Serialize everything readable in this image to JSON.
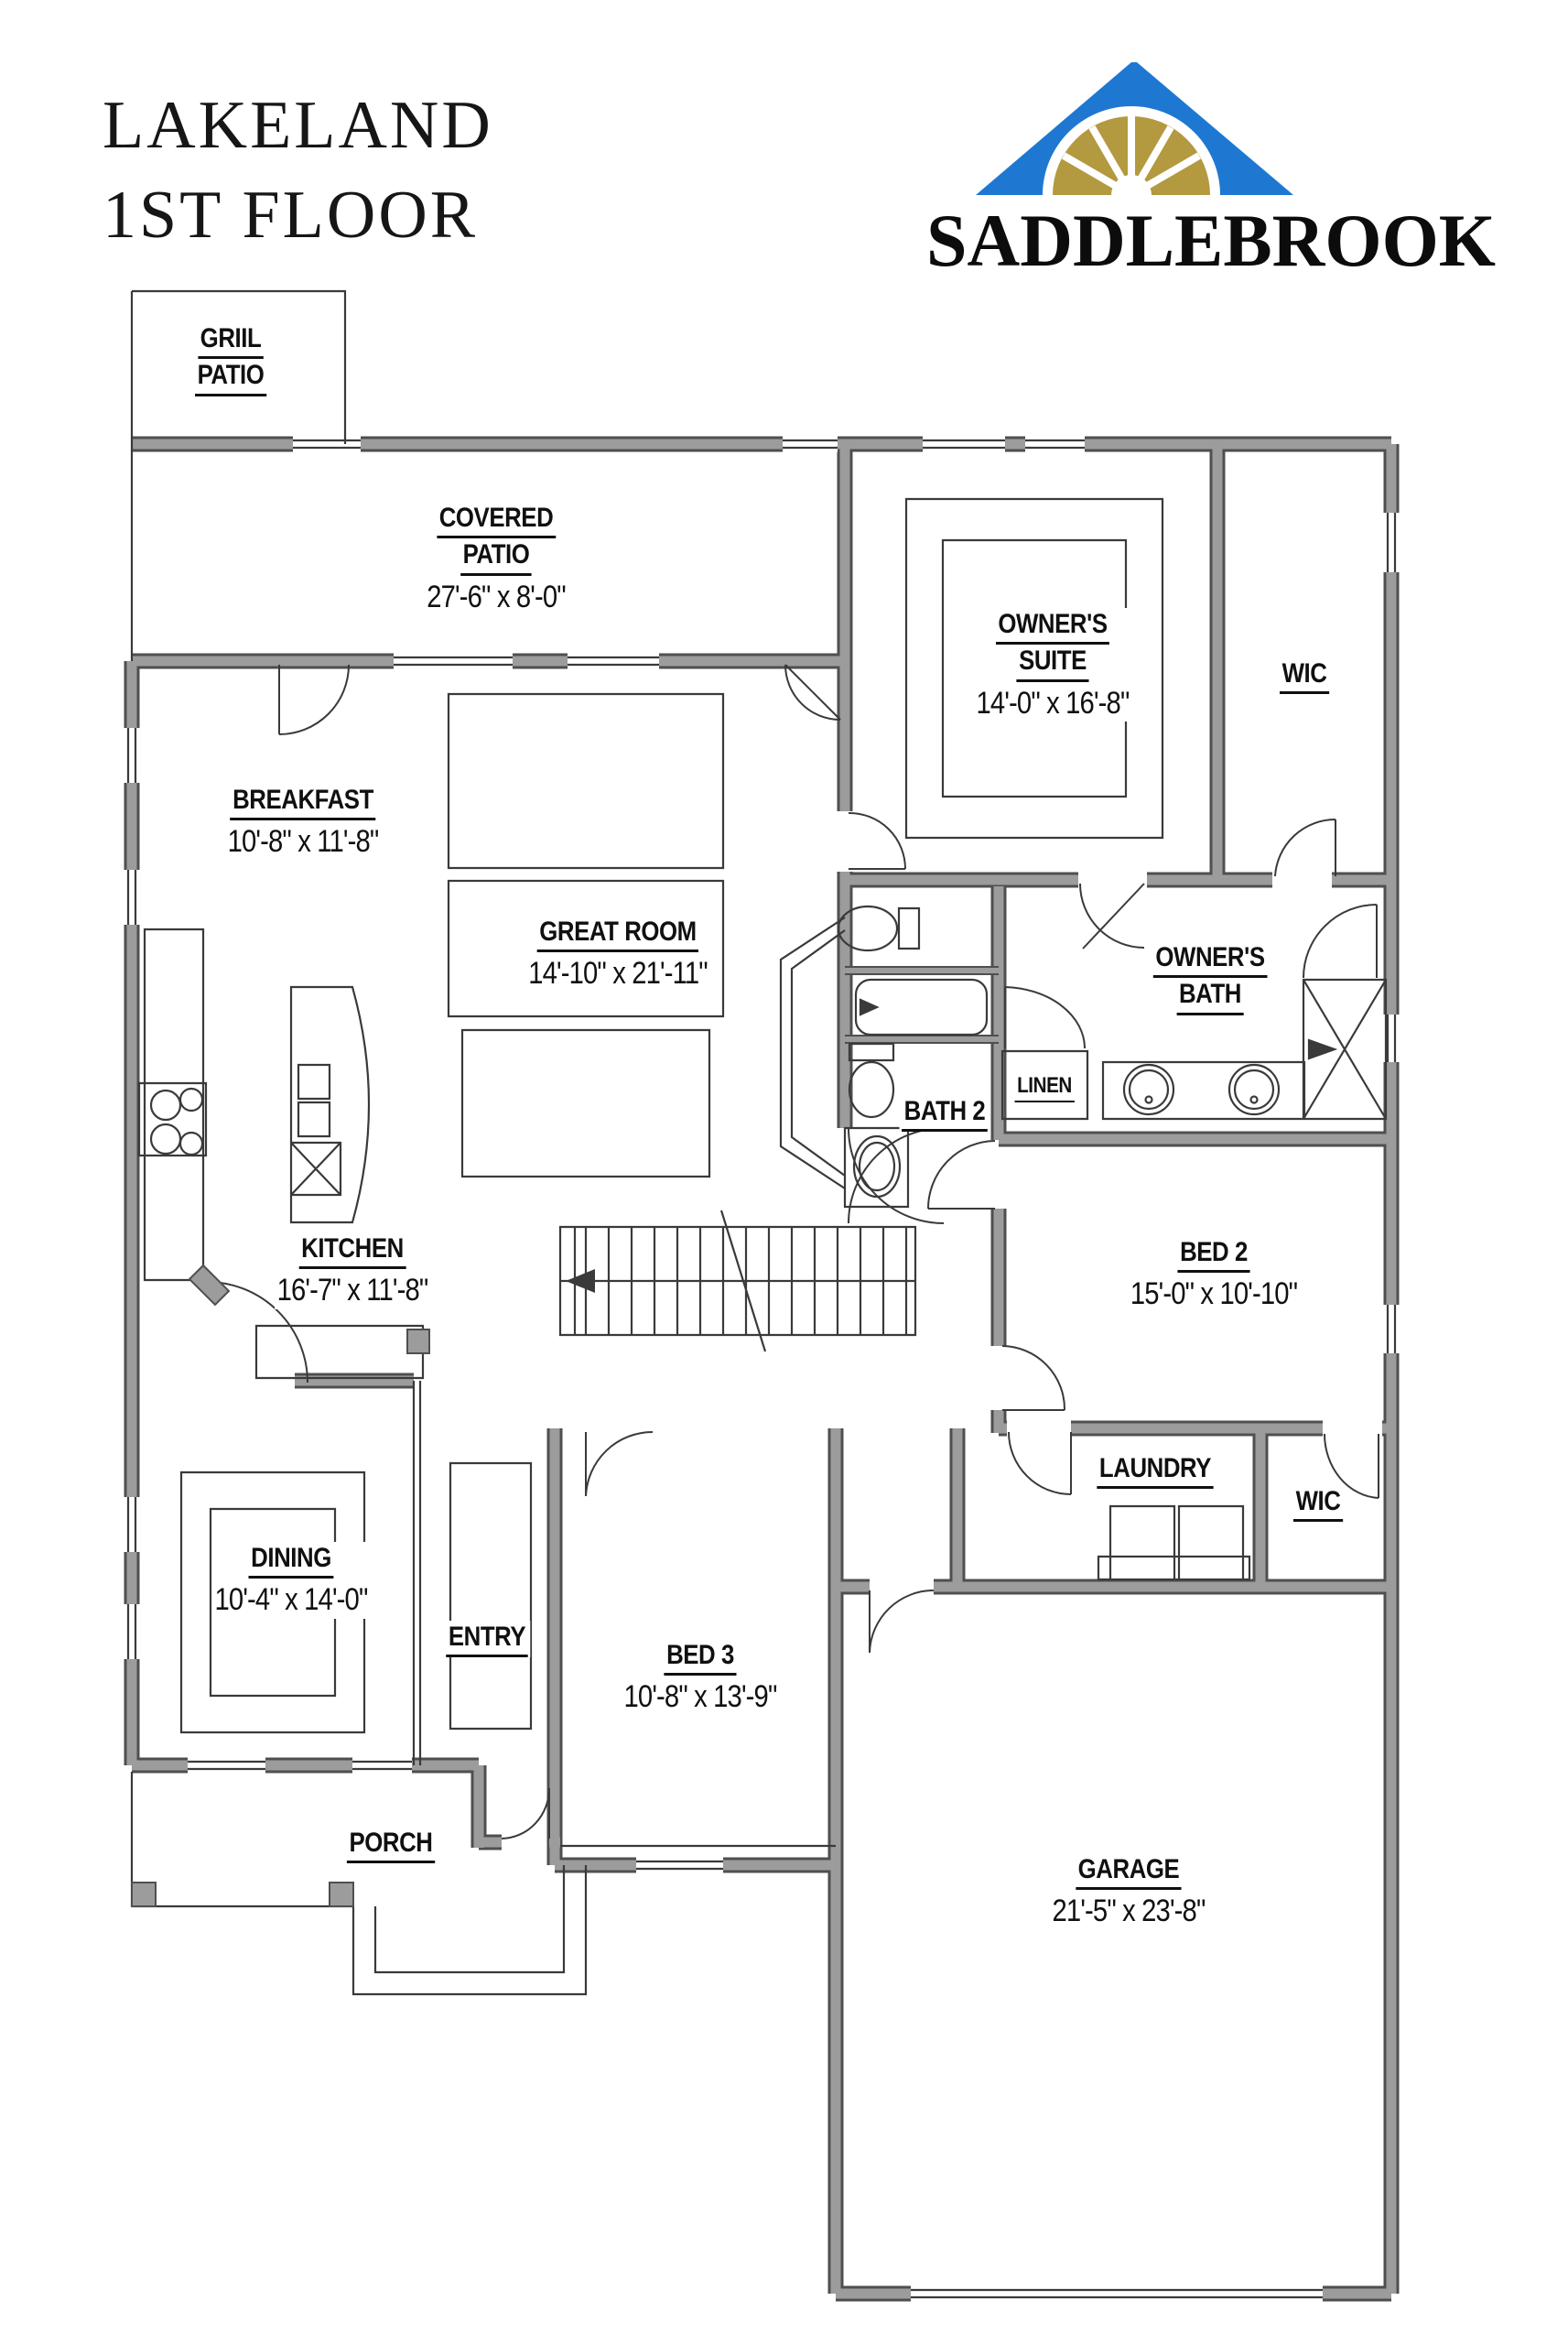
{
  "header": {
    "title_line1": "LAKELAND",
    "title_line2": "1ST FLOOR",
    "brand": "SADDLEBROOK"
  },
  "rooms": {
    "grill_patio": {
      "line1": "GRIIL",
      "line2": "PATIO"
    },
    "covered_patio": {
      "line1": "COVERED",
      "line2": "PATIO",
      "dims": "27'-6\" x 8'-0\""
    },
    "owners_suite": {
      "line1": "OWNER'S",
      "line2": "SUITE",
      "dims": "14'-0\" x 16'-8\""
    },
    "wic_upper": {
      "line1": "WIC"
    },
    "breakfast": {
      "line1": "BREAKFAST",
      "dims": "10'-8\" x 11'-8\""
    },
    "great_room": {
      "line1": "GREAT ROOM",
      "dims": "14'-10\" x 21'-11\""
    },
    "owners_bath": {
      "line1": "OWNER'S",
      "line2": "BATH"
    },
    "bath2": {
      "line1": "BATH 2"
    },
    "linen": {
      "line1": "LINEN"
    },
    "bed2": {
      "line1": "BED 2",
      "dims": "15'-0\" x 10'-10\""
    },
    "kitchen": {
      "line1": "KITCHEN",
      "dims": "16'-7\" x 11'-8\""
    },
    "laundry": {
      "line1": "LAUNDRY"
    },
    "wic_lower": {
      "line1": "WIC"
    },
    "dining": {
      "line1": "DINING",
      "dims": "10'-4\" x 14'-0\""
    },
    "entry": {
      "line1": "ENTRY"
    },
    "bed3": {
      "line1": "BED 3",
      "dims": "10'-8\" x 13'-9\""
    },
    "porch": {
      "line1": "PORCH"
    },
    "garage": {
      "line1": "GARAGE",
      "dims": "21'-5\" x 23'-8\""
    }
  },
  "colors": {
    "wall_fill": "#9c9c9c",
    "wall_edge": "#4f4f4f",
    "line": "#3a3a3a",
    "text": "#101010",
    "logo_blue": "#1e78d2",
    "logo_gold": "#b3993f"
  }
}
